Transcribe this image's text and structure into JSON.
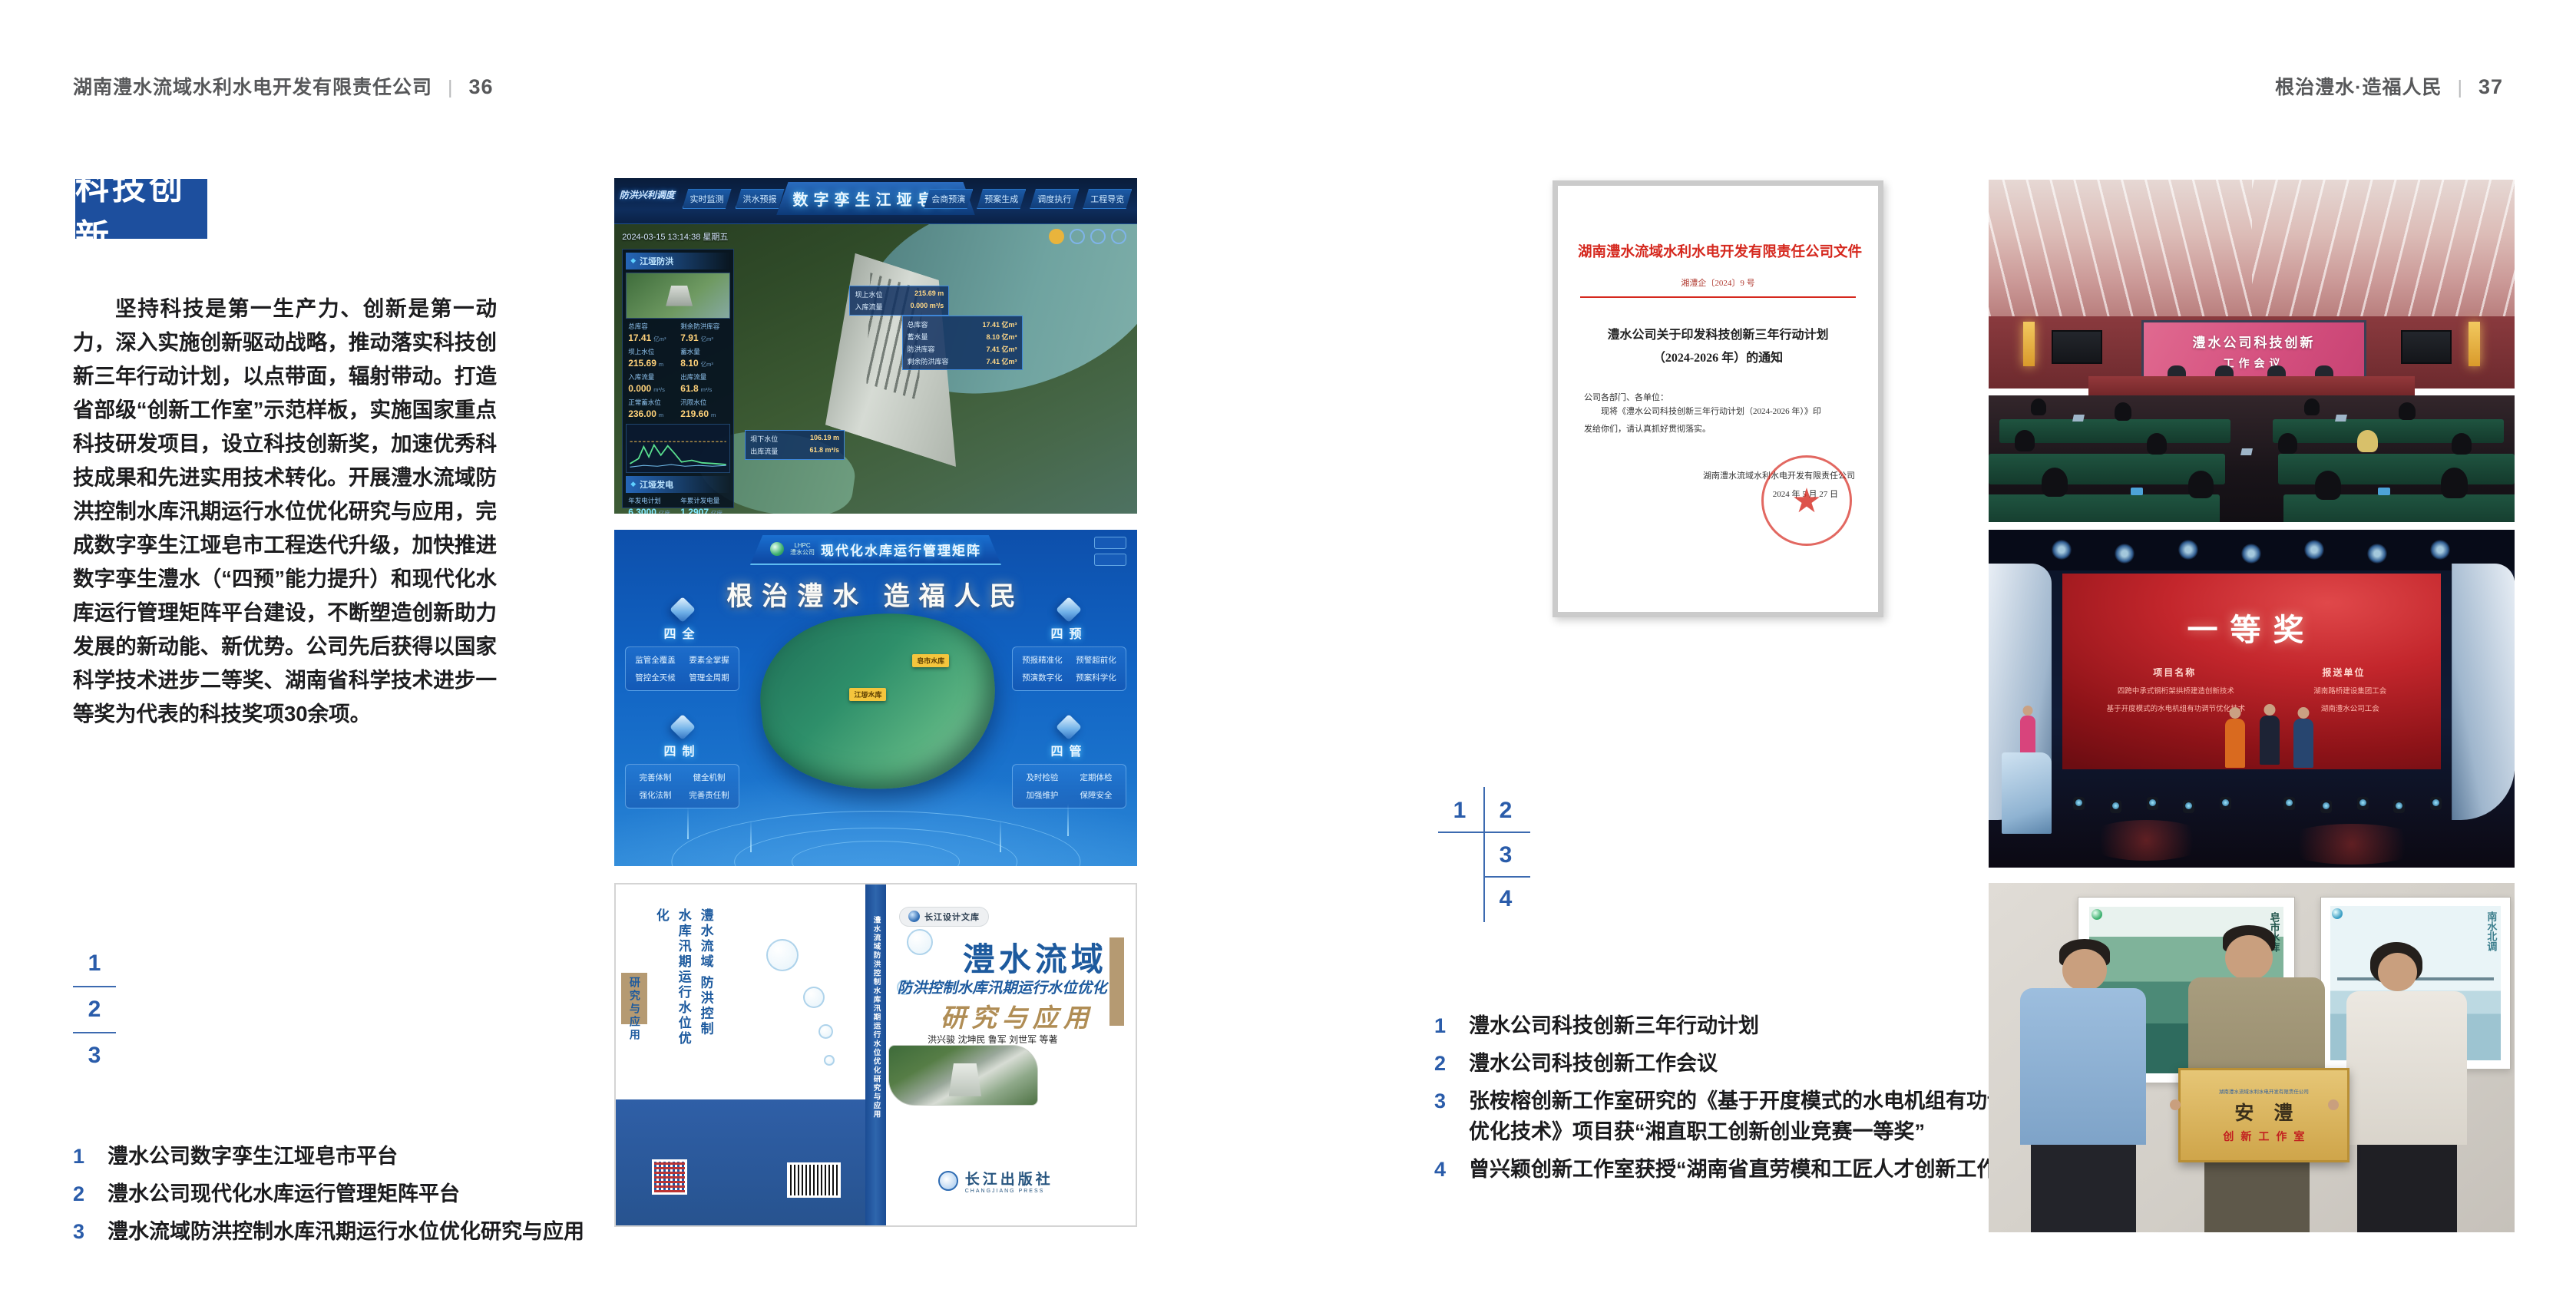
{
  "colors": {
    "accent_blue": "#1d4f9e",
    "caption_blue": "#2a5caa",
    "doc_red": "#d5281e",
    "screen_pink": "#d44f7e",
    "award_red": "#c3262c",
    "plaque_gold": "#cfa54a",
    "header_gray": "#57585a"
  },
  "page_left": {
    "header": {
      "company": "湖南澧水流域水利水电开发有限责任公司",
      "separator": "|",
      "page_number": "36"
    },
    "badge": "科技创新",
    "paragraph": "坚持科技是第一生产力、创新是第一动力，深入实施创新驱动战略，推动落实科技创新三年行动计划，以点带面，辐射带动。打造省部级“创新工作室”示范样板，实施国家重点科技研发项目，设立科技创新奖，加速优秀科技成果和先进实用技术转化。开展澧水流域防洪控制水库汛期运行水位优化研究与应用，完成数字孪生江垭皂市工程迭代升级，加快推进数字孪生澧水（“四预”能力提升）和现代化水库运行管理矩阵平台建设，不断塑造创新助力发展的新动能、新优势。公司先后获得以国家科学技术进步二等奖、湖南省科学技术进步一等奖为代表的科技奖项30余项。",
    "figure_index": {
      "n1": "1",
      "n2": "2",
      "n3": "3"
    },
    "captions": [
      {
        "n": "1",
        "t": "澧水公司数字孪生江垭皂市平台"
      },
      {
        "n": "2",
        "t": "澧水公司现代化水库运行管理矩阵平台"
      },
      {
        "n": "3",
        "t": "澧水流域防洪控制水库汛期运行水位优化研究与应用"
      }
    ],
    "dashboard": {
      "title": "数字孪生江垭皂市",
      "timestamp": "2024-03-15 13:14:38 星期五",
      "home_tab": "防洪兴利调度",
      "tabs_left": [
        "实时监测",
        "洪水预报",
        "防洪预警"
      ],
      "tabs_right": [
        "会商预演",
        "预案生成",
        "调度执行",
        "工程导览"
      ],
      "flood_panel": {
        "title": "江垭防洪",
        "stats": [
          {
            "label": "总库容",
            "value": "17.41",
            "unit": "亿m³"
          },
          {
            "label": "剩余防洪库容",
            "value": "7.91",
            "unit": "亿m³"
          },
          {
            "label": "坝上水位",
            "value": "215.69",
            "unit": "m"
          },
          {
            "label": "蓄水量",
            "value": "8.10",
            "unit": "亿m³"
          },
          {
            "label": "入库流量",
            "value": "0.000",
            "unit": "m³/s"
          },
          {
            "label": "出库流量",
            "value": "61.8",
            "unit": "m³/s"
          },
          {
            "label": "正常蓄水位",
            "value": "236.00",
            "unit": "m"
          },
          {
            "label": "汛限水位",
            "value": "219.60",
            "unit": "m"
          }
        ]
      },
      "power_panel": {
        "title": "江垭发电",
        "stats": [
          {
            "label": "年发电计划",
            "value": "6.3000",
            "unit": "亿度"
          },
          {
            "label": "年累计发电量",
            "value": "1.2907",
            "unit": "亿度"
          },
          {
            "label": "月累计发电量",
            "value": "3359.21",
            "unit": "万度"
          },
          {
            "label": "当前出力",
            "value": "0.00",
            "unit": "MW"
          }
        ]
      },
      "map_chip_upper": [
        {
          "label": "坝上水位",
          "value": "215.69 m"
        },
        {
          "label": "入库流量",
          "value": "0.000 m³/s"
        }
      ],
      "map_chip_right": [
        {
          "label": "总库容",
          "value": "17.41 亿m³"
        },
        {
          "label": "蓄水量",
          "value": "8.10 亿m³"
        },
        {
          "label": "防洪库容",
          "value": "7.41 亿m³"
        },
        {
          "label": "剩余防洪库容",
          "value": "7.41 亿m³"
        }
      ],
      "map_chip_lower": [
        {
          "label": "坝下水位",
          "value": "106.19 m"
        },
        {
          "label": "出库流量",
          "value": "61.8 m³/s"
        }
      ]
    },
    "matrix": {
      "logo_line1": "LHPC",
      "logo_line2": "澧水公司",
      "title": "现代化水库运行管理矩阵",
      "slogan": "根治澧水 造福人民",
      "panels": [
        {
          "name": "四全",
          "items": [
            "监管全覆盖",
            "要素全掌握",
            "管控全天候",
            "管理全周期"
          ]
        },
        {
          "name": "四预",
          "items": [
            "预报精准化",
            "预警超前化",
            "预演数字化",
            "预案科学化"
          ]
        },
        {
          "name": "四制",
          "items": [
            "完善体制",
            "健全机制",
            "强化法制",
            "完善责任制"
          ]
        },
        {
          "name": "四管",
          "items": [
            "及时检验",
            "定期体检",
            "加强维护",
            "保障安全"
          ]
        }
      ],
      "map_labels": [
        "皂市水库",
        "江垭水库"
      ]
    },
    "book": {
      "series": "长江设计文库",
      "title_region": "澧水流域",
      "title_sub": "防洪控制水库汛期运行水位优化",
      "title_tail": "研究与应用",
      "back_title": "澧水流域 防洪控制水库汛期运行水位优化",
      "back_tail": "研究与应用",
      "authors": "洪兴骏 沈坤民 鲁军 刘世军 等著",
      "publisher": "长江出版社",
      "publisher_en": "CHANGJIANG PRESS",
      "spine_text": "澧水流域防洪控制水库汛期运行水位优化研究与应用"
    }
  },
  "page_right": {
    "header": {
      "title": "根治澧水·造福人民",
      "separator": "|",
      "page_number": "37"
    },
    "document": {
      "heading": "湖南澧水流域水利水电开发有限责任公司文件",
      "doc_no": "湘澧企〔2024〕9 号",
      "title_line1": "澧水公司关于印发科技创新三年行动计划",
      "title_line2": "（2024-2026 年）的通知",
      "salutation": "公司各部门、各单位：",
      "body_line1": "现将《澧水公司科技创新三年行动计划（2024-2026 年）》印",
      "body_line2": "发给你们，请认真抓好贯彻落实。",
      "signer": "湖南澧水流域水利水电开发有限责任公司",
      "date": "2024 年 5 月 27 日",
      "seal_star": "★"
    },
    "figure_index": {
      "n1": "1",
      "n2": "2",
      "n3": "3",
      "n4": "4"
    },
    "captions": [
      {
        "n": "1",
        "t": "澧水公司科技创新三年行动计划"
      },
      {
        "n": "2",
        "t": "澧水公司科技创新工作会议"
      },
      {
        "n": "3",
        "t": "张桉榕创新工作室研究的《基于开度模式的水电机组有功调节优化技术》项目获“湘直职工创新创业竞赛一等奖”"
      },
      {
        "n": "4",
        "t": "曾兴颖创新工作室获授“湖南省直劳模和工匠人才创新工作室”"
      }
    ],
    "meeting_photo": {
      "screen_line1": "澧水公司科技创新",
      "screen_line2": "工作会议"
    },
    "stage_photo": {
      "award_title": "一等奖",
      "col1_header": "项目名称",
      "col2_header": "报送单位",
      "col1_lines": [
        "四跨中承式钢桁架拱桥建造创新技术",
        "基于开度模式的水电机组有功调节优化技术"
      ],
      "col2_lines": [
        "湖南路桥建设集团工会",
        "湖南澧水公司工会"
      ]
    },
    "plaque_photo": {
      "plaque_header": "湖南澧水流域水利水电开发有限责任公司",
      "plaque_title": "安澧",
      "plaque_subtitle": "创新工作室",
      "poster_left_label": "皂市水库",
      "poster_right_label": "南水北调"
    }
  }
}
